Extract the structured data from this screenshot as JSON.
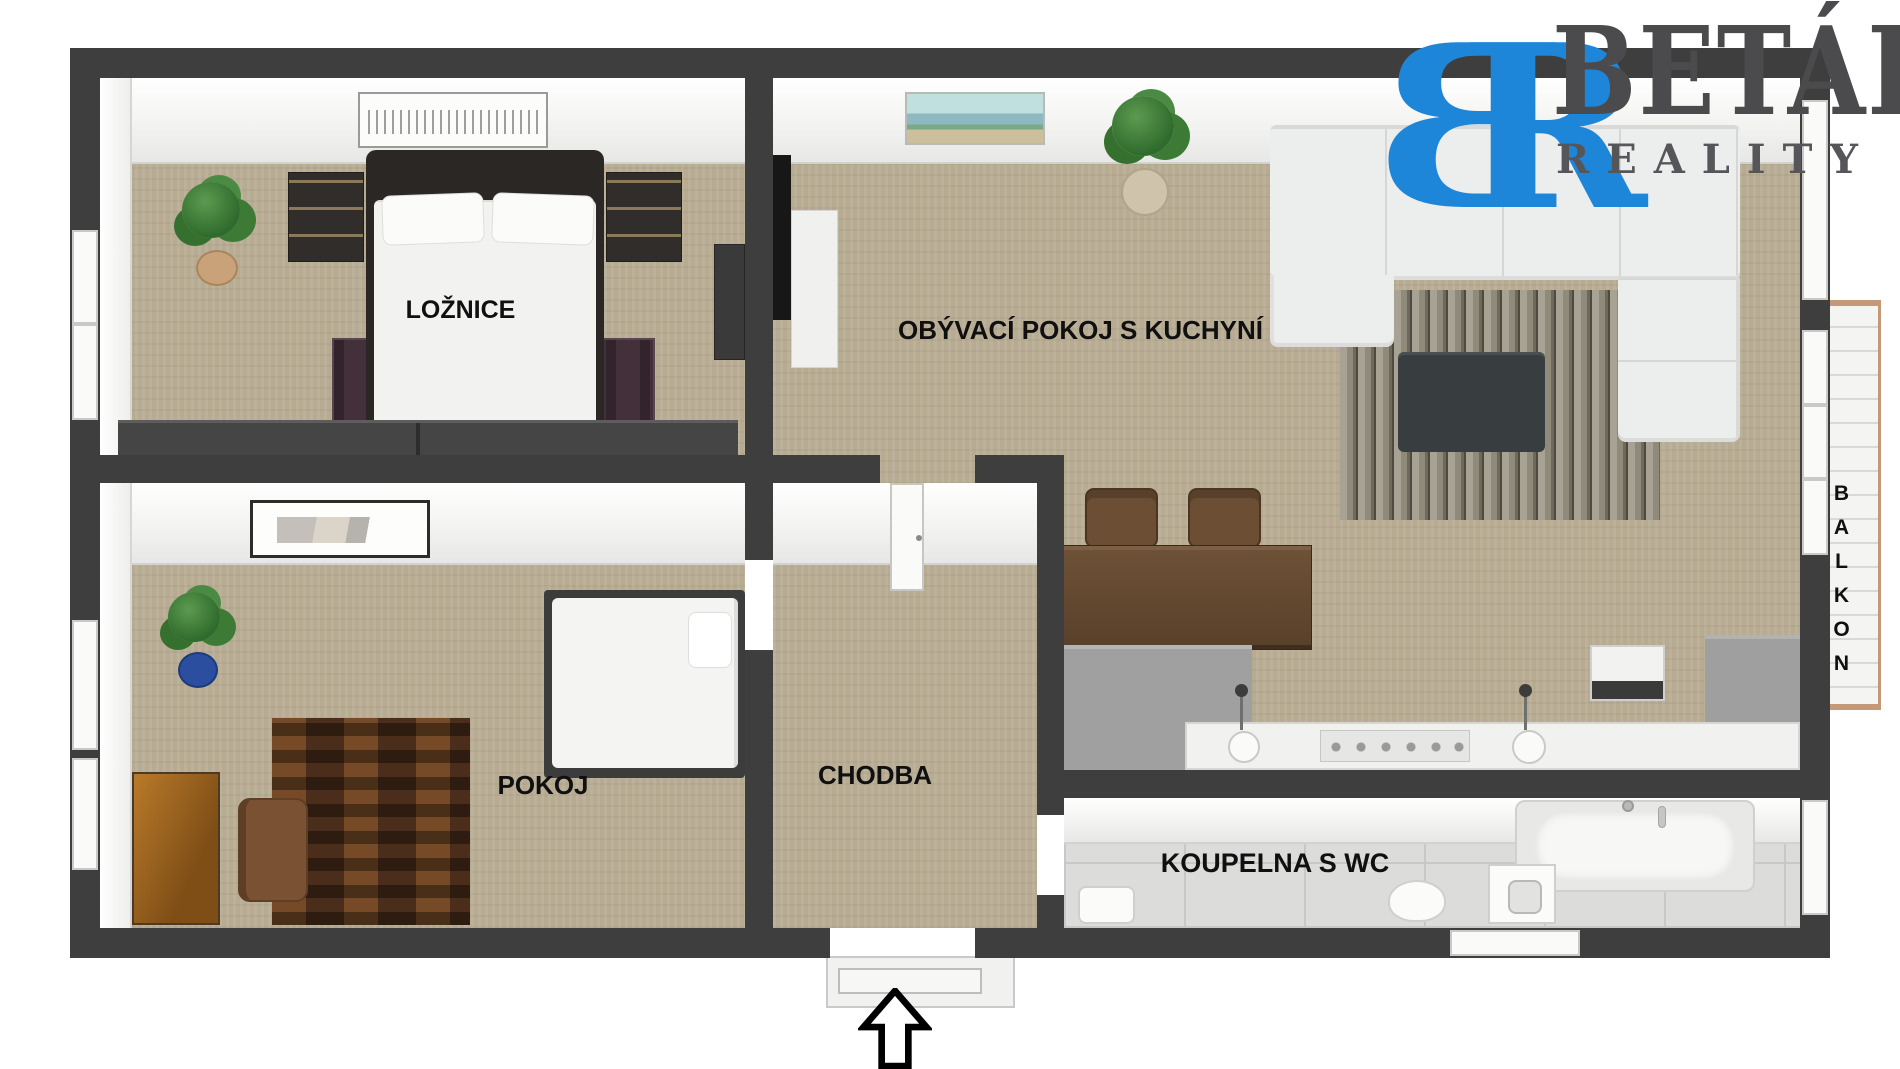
{
  "brand": {
    "monogram_left": "B",
    "monogram_right": "R",
    "name": "BETÁK",
    "tagline": "REALITY",
    "monogram_color": "#1e86d9",
    "name_color": "#4b4b4d"
  },
  "rooms": {
    "bedroom": {
      "label": "LOŽNICE"
    },
    "living_kitchen": {
      "label": "OBÝVACÍ POKOJ S KUCHYNÍ"
    },
    "small_room": {
      "label": "POKOJ"
    },
    "hallway": {
      "label": "CHODBA"
    },
    "bathroom": {
      "label": "KOUPELNA S WC"
    },
    "balcony": {
      "label": "BALKON"
    }
  },
  "icons": {
    "entrance": "entrance-arrow-up-icon"
  },
  "colors": {
    "walls": "#3e3e3e",
    "carpet": "#b7ab92",
    "bathroom_tile": "#dcdcda",
    "balcony_deck": "#f4f4f2",
    "accent_blue": "#1e86d9",
    "brand_text": "#4b4b4d"
  }
}
